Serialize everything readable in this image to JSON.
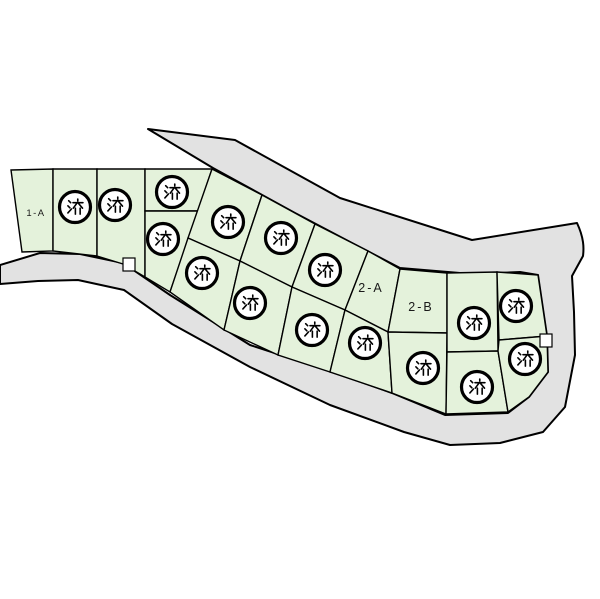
{
  "map": {
    "kind": "land-subdivision-plot-map",
    "stamp": {
      "text": "済",
      "meaning": "sold / reserved"
    },
    "colors": {
      "road_fill": "#e2e2e2",
      "plot_fill": "#e4f2db",
      "outline": "#000000",
      "stamp_ring": "#000000",
      "stamp_fill": "#ffffff",
      "background": "#ffffff"
    },
    "plots": [
      {
        "id": "1-A",
        "label": "1-A",
        "status": "available",
        "points": "11,170 53,169 53,251 22,252",
        "label_pos": [
          36,
          216
        ],
        "label_size": "small"
      },
      {
        "id": "1-row-2",
        "label": "",
        "status": "sold",
        "points": "53,169 97,169 97,256 53,251",
        "stamp": [
          75,
          207
        ]
      },
      {
        "id": "1-row-3",
        "label": "",
        "status": "sold",
        "points": "97,169 145,169 145,277 123,264 97,256",
        "stamp": [
          115,
          205
        ]
      },
      {
        "id": "1-row-4-upper",
        "label": "",
        "status": "sold",
        "points": "145,169 212,169 198,211 145,211",
        "stamp": [
          172,
          192
        ]
      },
      {
        "id": "1-row-4-lower",
        "label": "",
        "status": "sold",
        "points": "145,211 198,211 170,292 145,277",
        "stamp": [
          163,
          239
        ]
      },
      {
        "id": "strip-upper-1",
        "label": "",
        "status": "sold",
        "points": "212,169 262,195 240,261 188,238",
        "stamp": [
          228,
          222
        ]
      },
      {
        "id": "strip-upper-2",
        "label": "",
        "status": "sold",
        "points": "262,195 315,224 292,287 240,261",
        "stamp": [
          281,
          238
        ]
      },
      {
        "id": "strip-upper-3",
        "label": "",
        "status": "sold",
        "points": "315,224 368,251 345,310 292,287",
        "stamp": [
          325,
          270
        ]
      },
      {
        "id": "2-A",
        "label": "2-A",
        "status": "available",
        "points": "368,251 400,269 388,332 345,310",
        "label_pos": [
          371,
          292
        ],
        "label_size": "big"
      },
      {
        "id": "2-B",
        "label": "2-B",
        "status": "available",
        "points": "400,269 447,273 447,333 388,332",
        "label_pos": [
          421,
          311
        ],
        "label_size": "big"
      },
      {
        "id": "strip-lower-1",
        "label": "",
        "status": "sold",
        "points": "188,238 240,261 224,330 170,292",
        "stamp": [
          202,
          273
        ]
      },
      {
        "id": "strip-lower-2",
        "label": "",
        "status": "sold",
        "points": "240,261 292,287 278,355 224,330",
        "stamp": [
          250,
          303
        ]
      },
      {
        "id": "strip-lower-3",
        "label": "",
        "status": "sold",
        "points": "292,287 345,310 330,372 278,355",
        "stamp": [
          312,
          330
        ]
      },
      {
        "id": "strip-lower-4",
        "label": "",
        "status": "sold",
        "points": "345,310 388,332 392,393 330,372",
        "stamp": [
          365,
          343
        ]
      },
      {
        "id": "east-lower-left",
        "label": "",
        "status": "sold",
        "points": "388,332 447,333 446,414 392,393",
        "stamp": [
          423,
          368
        ]
      },
      {
        "id": "east-top-left",
        "label": "",
        "status": "sold",
        "points": "447,273 497,272 498,351 447,352",
        "stamp": [
          474,
          323
        ]
      },
      {
        "id": "east-top-right",
        "label": "",
        "status": "sold",
        "points": "497,272 538,275 547,336 499,340",
        "stamp": [
          516,
          306
        ]
      },
      {
        "id": "east-bottom-middle",
        "label": "",
        "status": "sold",
        "points": "447,352 498,351 508,412 446,414",
        "stamp": [
          477,
          387
        ]
      },
      {
        "id": "east-right",
        "label": "",
        "status": "sold",
        "points": "499,340 547,336 548,372 529,397 508,412 498,351",
        "stamp": [
          525,
          359
        ]
      }
    ],
    "notches": [
      {
        "x": 123,
        "y": 258,
        "w": 12,
        "h": 13
      },
      {
        "x": 540,
        "y": 334,
        "w": 12,
        "h": 13
      }
    ],
    "counts": {
      "total_plots": 19,
      "sold_stamps": 16,
      "labeled_available": [
        "1-A",
        "2-A",
        "2-B"
      ]
    }
  }
}
